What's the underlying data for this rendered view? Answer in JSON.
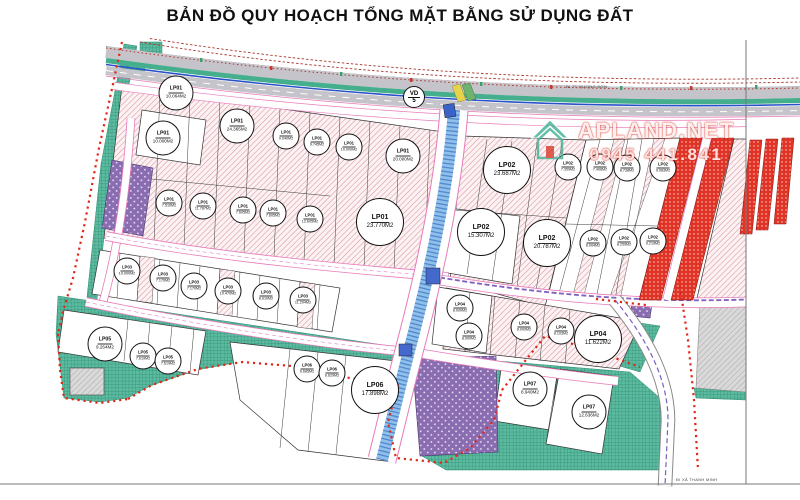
{
  "title": "BẢN ĐỒ QUY HOẠCH TỔNG MẶT BẰNG SỬ DỤNG ĐẤT",
  "watermark": {
    "brand": "APLAND.NET",
    "phone": "0945 441.841"
  },
  "road_labels": {
    "route_circle_top": "VD",
    "route_circle_bottom": "5",
    "direction_top_right": "ĐI TT HƯƠNG SƠN",
    "direction_bottom_right": "ĐI XÃ THANH MINH"
  },
  "colors": {
    "residential_hatch": "#d9939e",
    "green_space": "#5cbaa0",
    "infrastructure_purple": "#8a6cb0",
    "commercial_red": "#e03326",
    "canal_blue": "#8fc0ea",
    "boundary_red": "#e02818",
    "road_edge_pink": "#e87ab8"
  },
  "lots": [
    {
      "code": "LP01",
      "area": "10.064M2",
      "x": 176,
      "y": 93,
      "s": "md"
    },
    {
      "code": "LP01",
      "area": "24.365M2",
      "x": 237,
      "y": 126,
      "s": "md"
    },
    {
      "code": "LP01",
      "area": "10.000M2",
      "x": 163,
      "y": 138,
      "s": "md"
    },
    {
      "code": "LP01",
      "area": "9.040M2",
      "x": 286,
      "y": 136,
      "s": "sm"
    },
    {
      "code": "LP01",
      "area": "9.745M2",
      "x": 317,
      "y": 142,
      "s": "sm"
    },
    {
      "code": "LP01",
      "area": "10.000M2",
      "x": 349,
      "y": 147,
      "s": "sm"
    },
    {
      "code": "LP01",
      "area": "20.000M2",
      "x": 403,
      "y": 156,
      "s": "md"
    },
    {
      "code": "LP01",
      "area": "23.770M2",
      "x": 380,
      "y": 222,
      "s": "lg"
    },
    {
      "code": "LP01",
      "area": "7.510M2",
      "x": 169,
      "y": 203,
      "s": "sm"
    },
    {
      "code": "LP01",
      "area": "11.787M2",
      "x": 203,
      "y": 206,
      "s": "sm"
    },
    {
      "code": "LP01",
      "area": "7.605M2",
      "x": 243,
      "y": 210,
      "s": "sm"
    },
    {
      "code": "LP01",
      "area": "7.605M2",
      "x": 273,
      "y": 213,
      "s": "sm"
    },
    {
      "code": "LP01",
      "area": "12.605M2",
      "x": 310,
      "y": 219,
      "s": "sm"
    },
    {
      "code": "LP03",
      "area": "10.000M2",
      "x": 127,
      "y": 271,
      "s": "sm"
    },
    {
      "code": "LP03",
      "area": "7.170M2",
      "x": 163,
      "y": 278,
      "s": "sm"
    },
    {
      "code": "LP03",
      "area": "7.170M2",
      "x": 194,
      "y": 286,
      "s": "sm"
    },
    {
      "code": "LP03",
      "area": "10.470M2",
      "x": 228,
      "y": 291,
      "s": "sm"
    },
    {
      "code": "LP03",
      "area": "8.610M2",
      "x": 266,
      "y": 296,
      "s": "sm"
    },
    {
      "code": "LP03",
      "area": "11.204M2",
      "x": 303,
      "y": 300,
      "s": "sm"
    },
    {
      "code": "LP02",
      "area": "23.687M2",
      "x": 507,
      "y": 170,
      "s": "lg"
    },
    {
      "code": "LP02",
      "area": "15.307M2",
      "x": 481,
      "y": 232,
      "s": "lg"
    },
    {
      "code": "LP02",
      "area": "20.787M2",
      "x": 547,
      "y": 243,
      "s": "lg"
    },
    {
      "code": "LP02",
      "area": "7.359M2",
      "x": 568,
      "y": 167,
      "s": "sm"
    },
    {
      "code": "LP02",
      "area": "7.408M2",
      "x": 600,
      "y": 167,
      "s": "sm"
    },
    {
      "code": "LP02",
      "area": "8.738M2",
      "x": 627,
      "y": 168,
      "s": "sm"
    },
    {
      "code": "LP02",
      "area": "9.083M2",
      "x": 663,
      "y": 168,
      "s": "sm"
    },
    {
      "code": "LP02",
      "area": "8.004M2",
      "x": 593,
      "y": 243,
      "s": "sm"
    },
    {
      "code": "LP02",
      "area": "8.259M2",
      "x": 624,
      "y": 242,
      "s": "sm"
    },
    {
      "code": "LP02",
      "area": "9.219M2",
      "x": 653,
      "y": 241,
      "s": "sm"
    },
    {
      "code": "LP04",
      "area": "8.000M2",
      "x": 460,
      "y": 308,
      "s": "sm"
    },
    {
      "code": "LP04",
      "area": "8.000M2",
      "x": 469,
      "y": 336,
      "s": "sm"
    },
    {
      "code": "LP04",
      "area": "8.000M2",
      "x": 524,
      "y": 327,
      "s": "sm"
    },
    {
      "code": "LP04",
      "area": "8.103M2",
      "x": 561,
      "y": 331,
      "s": "sm"
    },
    {
      "code": "LP04",
      "area": "11.622M2",
      "x": 598,
      "y": 339,
      "s": "lg"
    },
    {
      "code": "LP05",
      "area": "9.264M2",
      "x": 105,
      "y": 344,
      "s": "md"
    },
    {
      "code": "LP05",
      "area": "7.619M2",
      "x": 143,
      "y": 356,
      "s": "sm"
    },
    {
      "code": "LP05",
      "area": "7.619M2",
      "x": 168,
      "y": 361,
      "s": "sm"
    },
    {
      "code": "LP06",
      "area": "6.685M2",
      "x": 307,
      "y": 369,
      "s": "sm"
    },
    {
      "code": "LP06",
      "area": "6.629M2",
      "x": 332,
      "y": 373,
      "s": "sm"
    },
    {
      "code": "LP06",
      "area": "17.898M2",
      "x": 375,
      "y": 390,
      "s": "lg"
    },
    {
      "code": "LP07",
      "area": "8.940M2",
      "x": 530,
      "y": 389,
      "s": "md"
    },
    {
      "code": "LP07",
      "area": "12.636M2",
      "x": 589,
      "y": 412,
      "s": "md"
    }
  ]
}
